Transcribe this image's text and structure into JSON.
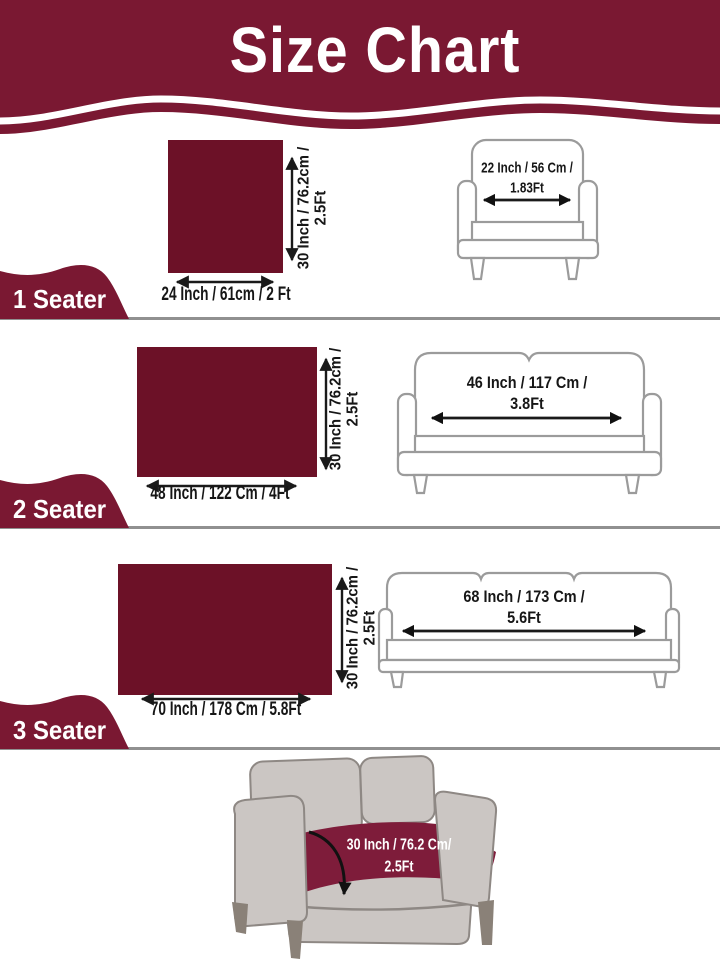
{
  "header": {
    "title": "Size Chart"
  },
  "colors": {
    "banner_maroon": "#7a1832",
    "swatch_maroon": "#6c1127",
    "cover_maroon": "#7e1c3a",
    "outline_gray": "#9b9b9b",
    "divider_gray": "#909090",
    "sofa_fill": "#cbc6c3",
    "leg_fill": "#8a8178"
  },
  "sections": [
    {
      "label": "1 Seater",
      "swatch": {
        "width_label": "24 Inch / 61cm / 2 Ft",
        "height_label_line1": "30 Inch / 76.2cm /",
        "height_label_line2": "2.5Ft"
      },
      "furniture": {
        "kind": "armchair",
        "width_label_line1": "22 Inch / 56 Cm /",
        "width_label_line2": "1.83Ft"
      }
    },
    {
      "label": "2 Seater",
      "swatch": {
        "width_label": "48 Inch / 122 Cm / 4Ft",
        "height_label_line1": "30 Inch / 76.2cm /",
        "height_label_line2": "2.5Ft"
      },
      "furniture": {
        "kind": "loveseat",
        "width_label_line1": "46 Inch / 117 Cm /",
        "width_label_line2": "3.8Ft"
      }
    },
    {
      "label": "3 Seater",
      "swatch": {
        "width_label": "70 Inch / 178 Cm / 5.8Ft",
        "height_label_line1": "30 Inch / 76.2cm /",
        "height_label_line2": "2.5Ft"
      },
      "furniture": {
        "kind": "sofa",
        "width_label_line1": "68 Inch / 173 Cm /",
        "width_label_line2": "5.6Ft"
      }
    }
  ],
  "footer": {
    "cover_depth_line1": "30 Inch / 76.2 Cm/",
    "cover_depth_line2": "2.5Ft"
  }
}
